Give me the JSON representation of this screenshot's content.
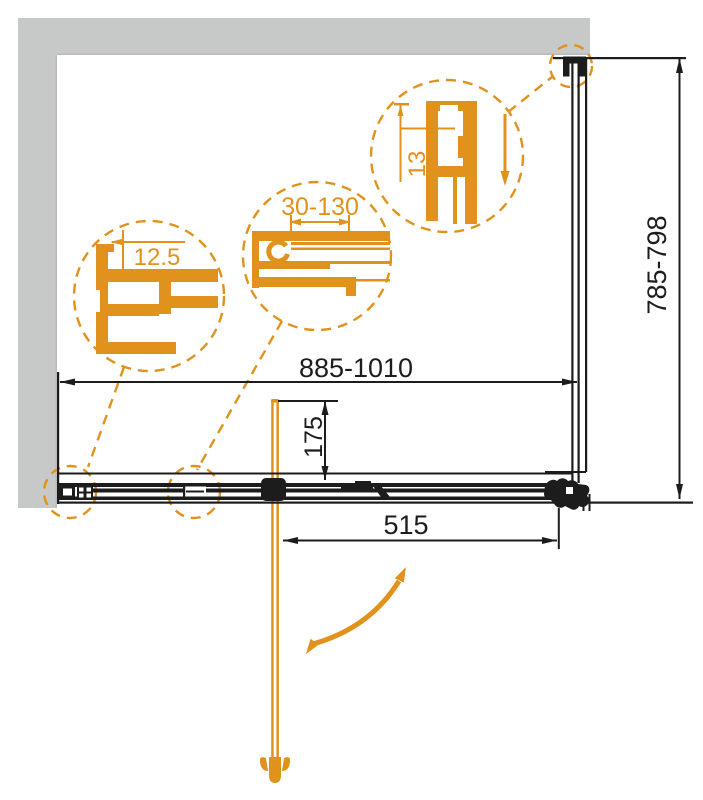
{
  "colors": {
    "accent": "#e0921c",
    "wall": "#c7c9c8",
    "line": "#1c1c1c",
    "bg": "#ffffff"
  },
  "dimensions": {
    "overall_width": "885-1010",
    "side_depth": "785-798",
    "door_width": "515",
    "pivot_offset": "175"
  },
  "callouts": {
    "wall_profile_adjust": "12.5",
    "width_adjust_range": "30-130",
    "top_profile_width": "13"
  }
}
